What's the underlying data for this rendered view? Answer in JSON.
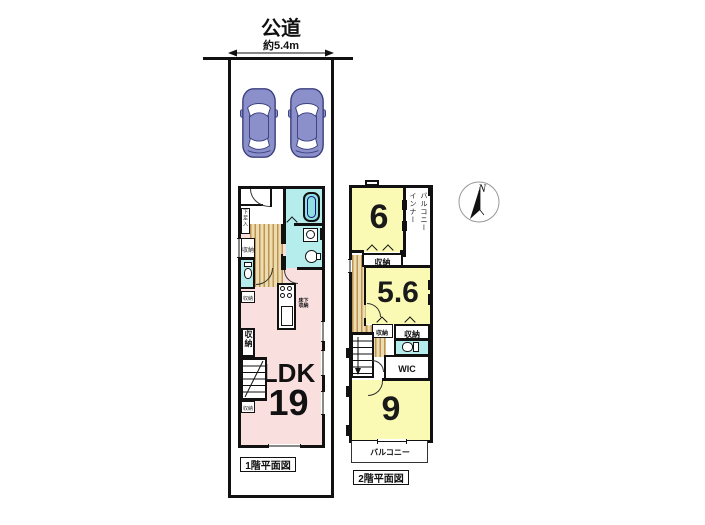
{
  "site": {
    "road_label": "公道",
    "road_width": "約5.4m"
  },
  "floor1": {
    "caption": "1階平面図",
    "ldk_label": "LDK",
    "ldk_size": "19",
    "shoe_cabinet": "下足入",
    "closet": "収納",
    "underfloor_line1": "床下",
    "underfloor_line2": "収納"
  },
  "floor2": {
    "caption": "2階平面図",
    "room6_size": "6",
    "room56_size": "5.6",
    "room9_size": "9",
    "closet": "収納",
    "wic": "WIC",
    "inner_balcony_col1": "インナー",
    "inner_balcony_col2": "バルコニー",
    "balcony": "バルコニー"
  },
  "compass": {
    "north": "N"
  },
  "colors": {
    "wall": "#111111",
    "room_yellow": "#fafab4",
    "wet_cyan": "#b5ecec",
    "ldk_pink": "#fadfdf",
    "hall_wood": "#bf9450",
    "car_blue": "#8b90cb"
  }
}
